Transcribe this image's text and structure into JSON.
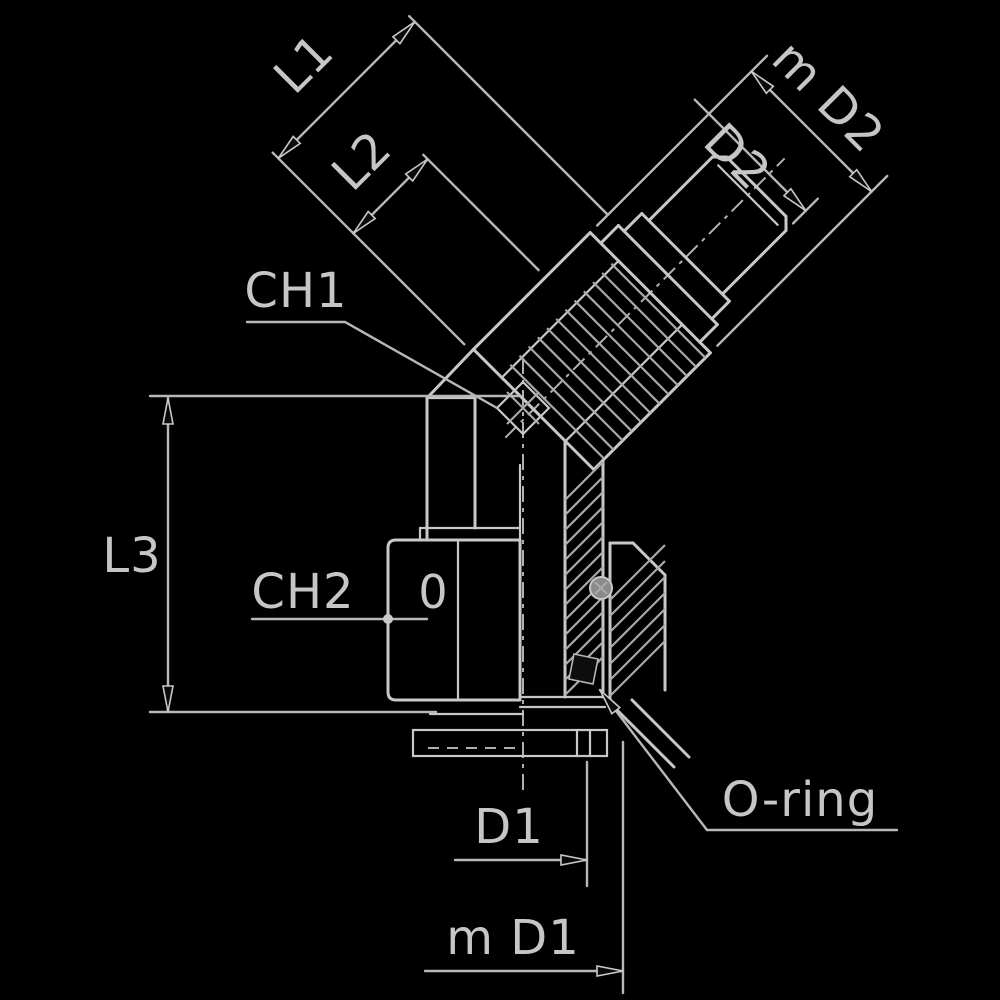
{
  "figure": {
    "kind": "technical-drawing",
    "subject": "45-degree fitting cross-section with dimension callouts",
    "labels": {
      "l1": "L1",
      "l2": "L2",
      "l3": "L3",
      "ch1": "CH1",
      "ch2": "CH2",
      "d1": "D1",
      "d2": "D2",
      "m_d1": "m D1",
      "m_d2": "m D2",
      "o_ring": "O-ring",
      "zero": "0"
    },
    "colors": {
      "background": "#000000",
      "line": "#c8c8c8",
      "dim_line": "#b8b8b8",
      "hatch": "#a9a9a9",
      "text": "#c6c6c6",
      "arrow_fill": "#0a0a0a"
    }
  }
}
